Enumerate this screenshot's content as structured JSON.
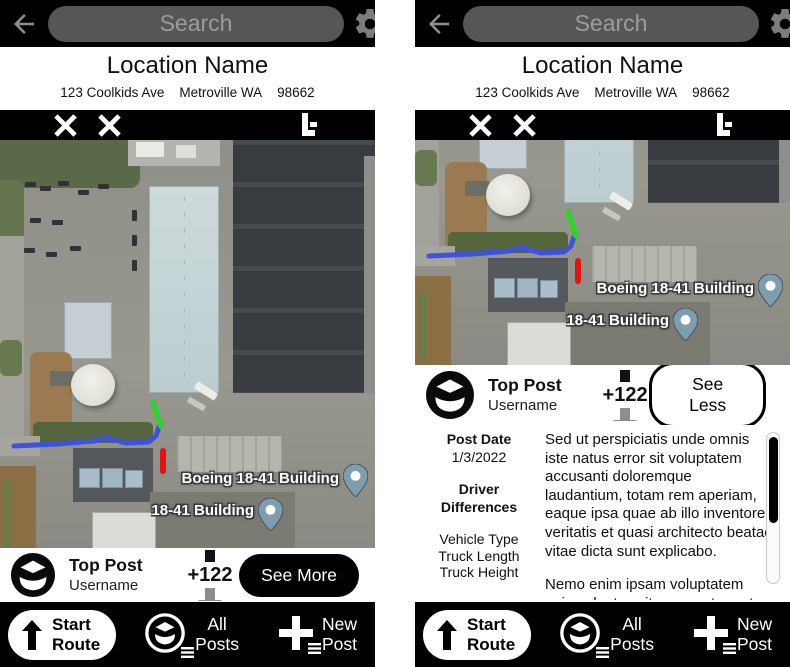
{
  "colors": {
    "route_blue": "#3f51e0",
    "route_green": "#2dd22d",
    "route_red": "#e51212",
    "map_pin": "#7e9dad",
    "bar_black": "#000000",
    "search_pill_gray": "#565656"
  },
  "header": {
    "search_placeholder": "Search"
  },
  "location": {
    "name": "Location Name",
    "street": "123 Coolkids Ave",
    "city": "Metroville WA",
    "zip": "98662"
  },
  "map": {
    "labels": [
      "Boeing 18-41 Building",
      "18-41 Building"
    ]
  },
  "post": {
    "title": "Top Post",
    "username": "Username",
    "vote_count": "+122",
    "expand_label": "See More",
    "collapse_label": "See Less"
  },
  "details": {
    "post_date_label": "Post Date",
    "post_date_value": "1/3/2022",
    "differences_label": "Driver Differences",
    "specs": [
      "Vehicle Type",
      "Truck Length",
      "Truck Height"
    ],
    "body_paragraph_1": "Sed ut perspiciatis unde omnis iste natus error sit voluptatem accusanti doloremque laudantium, totam rem aperiam, eaque ipsa quae ab illo inventore veritatis et quasi architecto beatae vitae dicta sunt explicabo.",
    "body_paragraph_2": "Nemo enim ipsam voluptatem quia voluptas sit aspernatur aut odit aut fugit, sed quia consequuntur magni"
  },
  "nav": {
    "start_line1": "Start",
    "start_line2": "Route",
    "all_line1": "All",
    "all_line2": "Posts",
    "new_line1": "New",
    "new_line2": "Post"
  }
}
